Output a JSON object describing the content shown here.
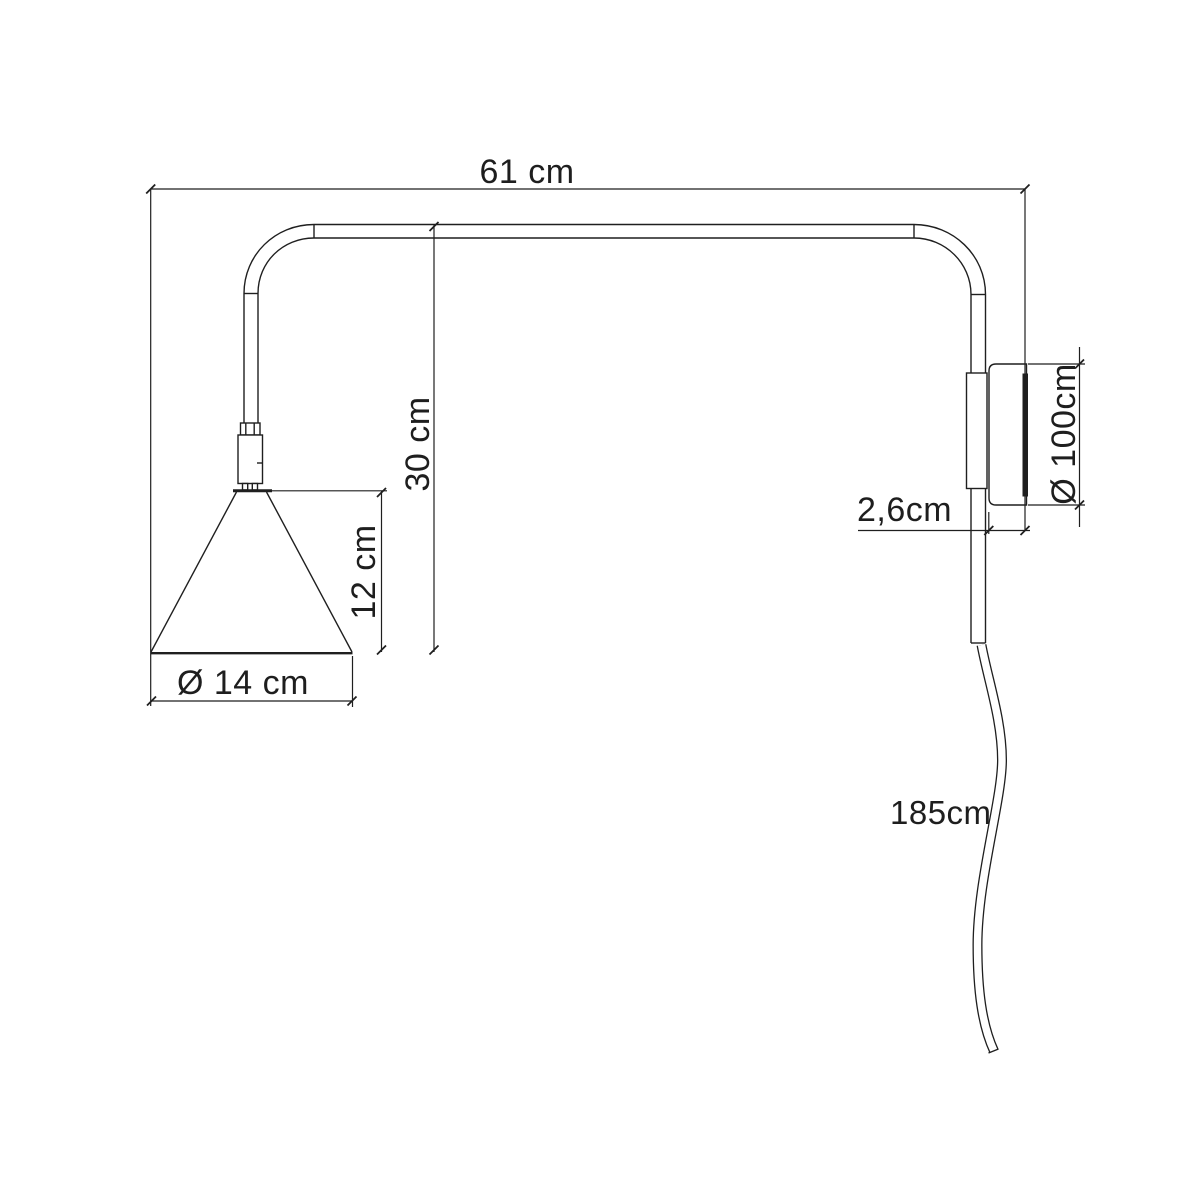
{
  "diagram": {
    "type": "technical-dimension-drawing",
    "subject": "wall lamp with swing arm, side view",
    "colors": {
      "background": "#ffffff",
      "line": "#1f1f1f"
    },
    "labels": {
      "arm_width": "61 cm",
      "height": "30 cm",
      "shade_height": "12 cm",
      "shade_diameter": "Ø 14 cm",
      "plate_depth": "2,6cm",
      "plate_diameter": "Ø 100cm",
      "cable_length": "185cm"
    }
  }
}
